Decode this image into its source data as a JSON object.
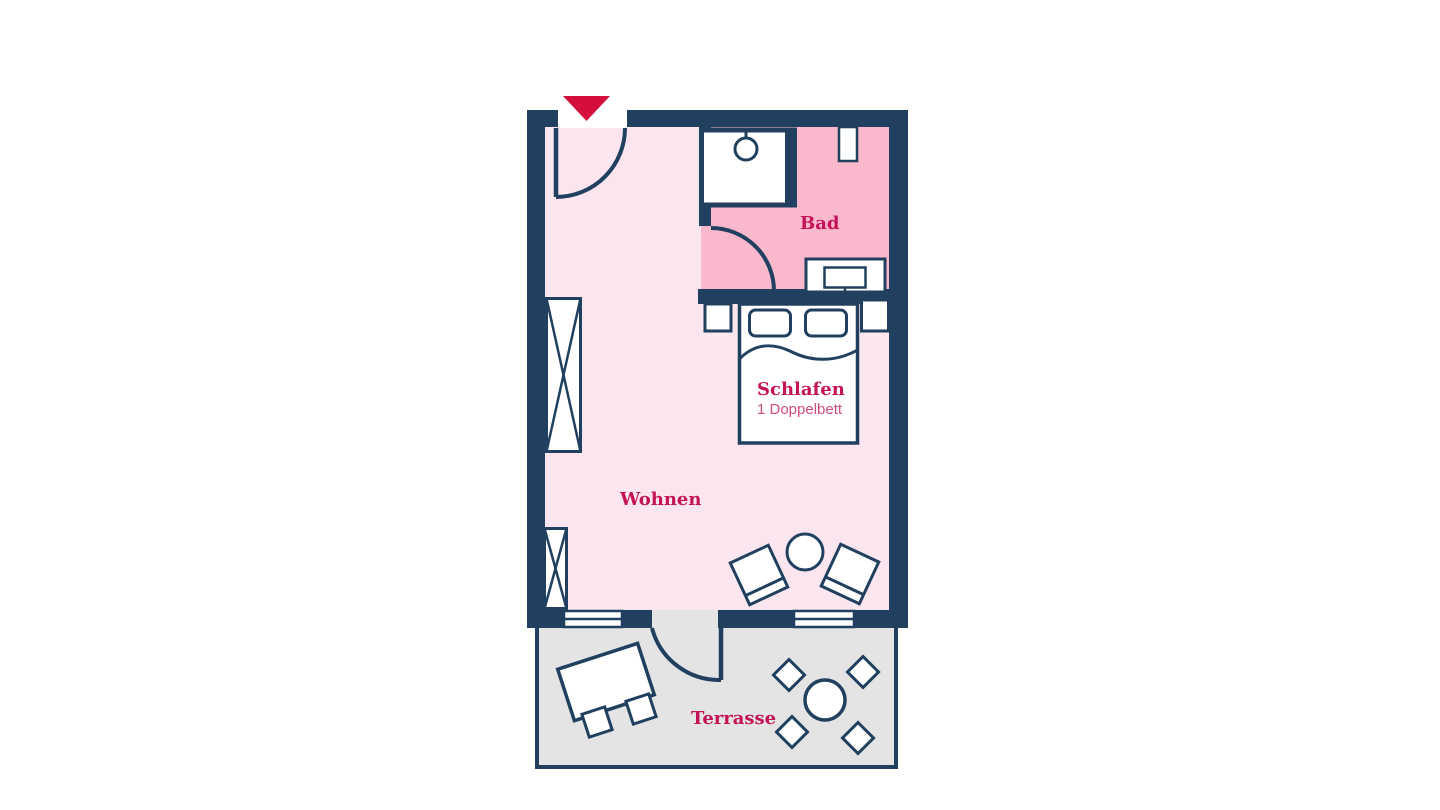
{
  "colors": {
    "wall": "#21405f",
    "room_floor": "#fbe5ef",
    "bathroom_floor": "#f9b8cc",
    "terrace_floor": "#e4e4e4",
    "label": "#c41356",
    "sublabel": "#cf4b80",
    "entrance_arrow": "#d40f3c",
    "background": "#ffffff",
    "furniture_fill": "#ffffff"
  },
  "rooms": {
    "bad": {
      "label": "Bad"
    },
    "schlafen": {
      "label": "Schlafen",
      "sublabel": "1 Doppelbett"
    },
    "wohnen": {
      "label": "Wohnen"
    },
    "terrasse": {
      "label": "Terrasse"
    }
  },
  "icons": [
    "entrance-arrow-icon",
    "entrance-door-swing-icon",
    "shower-icon",
    "bathroom-niche-icon",
    "washbasin-icon",
    "bathroom-door-swing-icon",
    "nightstand-icon",
    "double-bed-icon",
    "pillow-icon",
    "wardrobe-icon",
    "armchair-icon",
    "side-table-icon",
    "window-icon",
    "terrace-door-swing-icon",
    "terrace-table-icon",
    "terrace-chair-icon",
    "round-table-icon"
  ]
}
